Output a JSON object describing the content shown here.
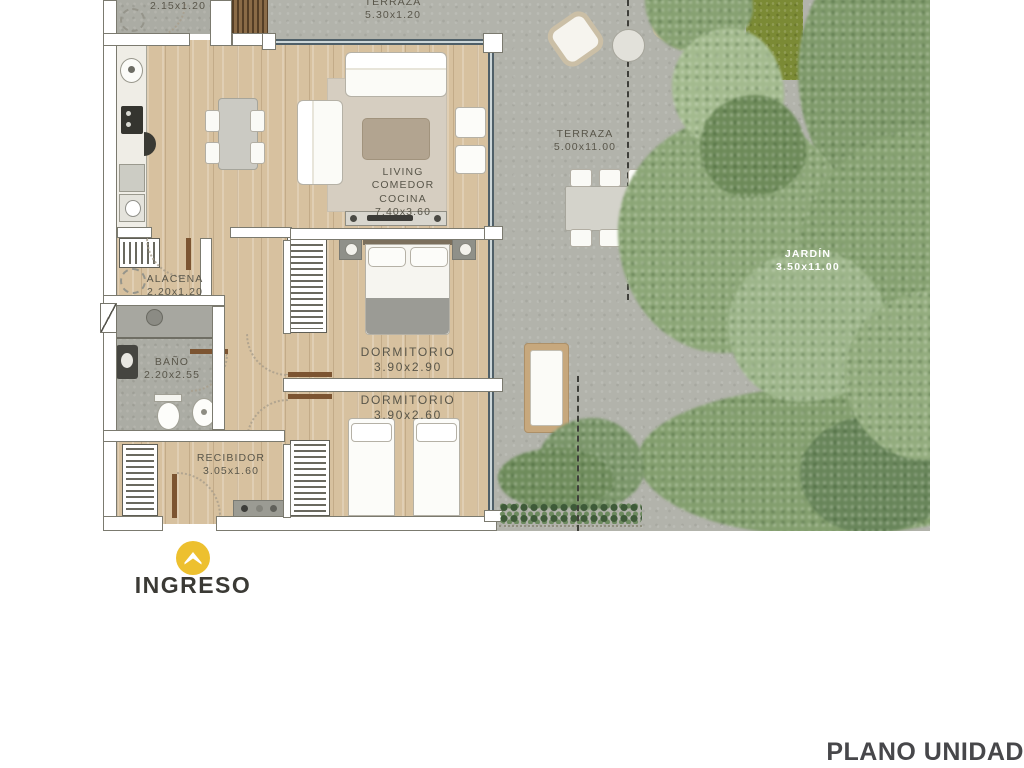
{
  "plan": {
    "rooms": {
      "patio": {
        "dims": "2.15x1.20"
      },
      "terraza_top": {
        "name": "TERRAZA",
        "dims": "5.30x1.20"
      },
      "living": {
        "line1": "LIVING",
        "line2": "COMEDOR",
        "line3": "COCINA",
        "dims": "7.40x3.60"
      },
      "alacena": {
        "name": "ALACENA",
        "dims": "2.20x1.20"
      },
      "bano": {
        "name": "BAÑO",
        "dims": "2.20x2.55"
      },
      "dorm1": {
        "name": "DORMITORIO",
        "dims": "3.90x2.90"
      },
      "dorm2": {
        "name": "DORMITORIO",
        "dims": "3.90x2.60"
      },
      "recibidor": {
        "name": "RECIBIDOR",
        "dims": "3.05x1.60"
      },
      "terraza": {
        "name": "TERRAZA",
        "dims": "5.00x11.00"
      },
      "jardin": {
        "name": "JARDÍN",
        "dims": "3.50x11.00"
      }
    },
    "entrance_label": "INGRESO",
    "footer_label": "PLANO UNIDAD",
    "icons": {
      "entrance": "chevron-up-marker-icon"
    },
    "colors": {
      "accent_yellow": "#edc02f",
      "wood": "#d7c19f",
      "concrete": "#b2b3ab",
      "tree_green": "#8ca677",
      "grass_green": "#7b8a35",
      "glass": "#4f5f68",
      "label_text": "#59564a",
      "footer_text": "#47474a",
      "background": "#ffffff"
    }
  }
}
